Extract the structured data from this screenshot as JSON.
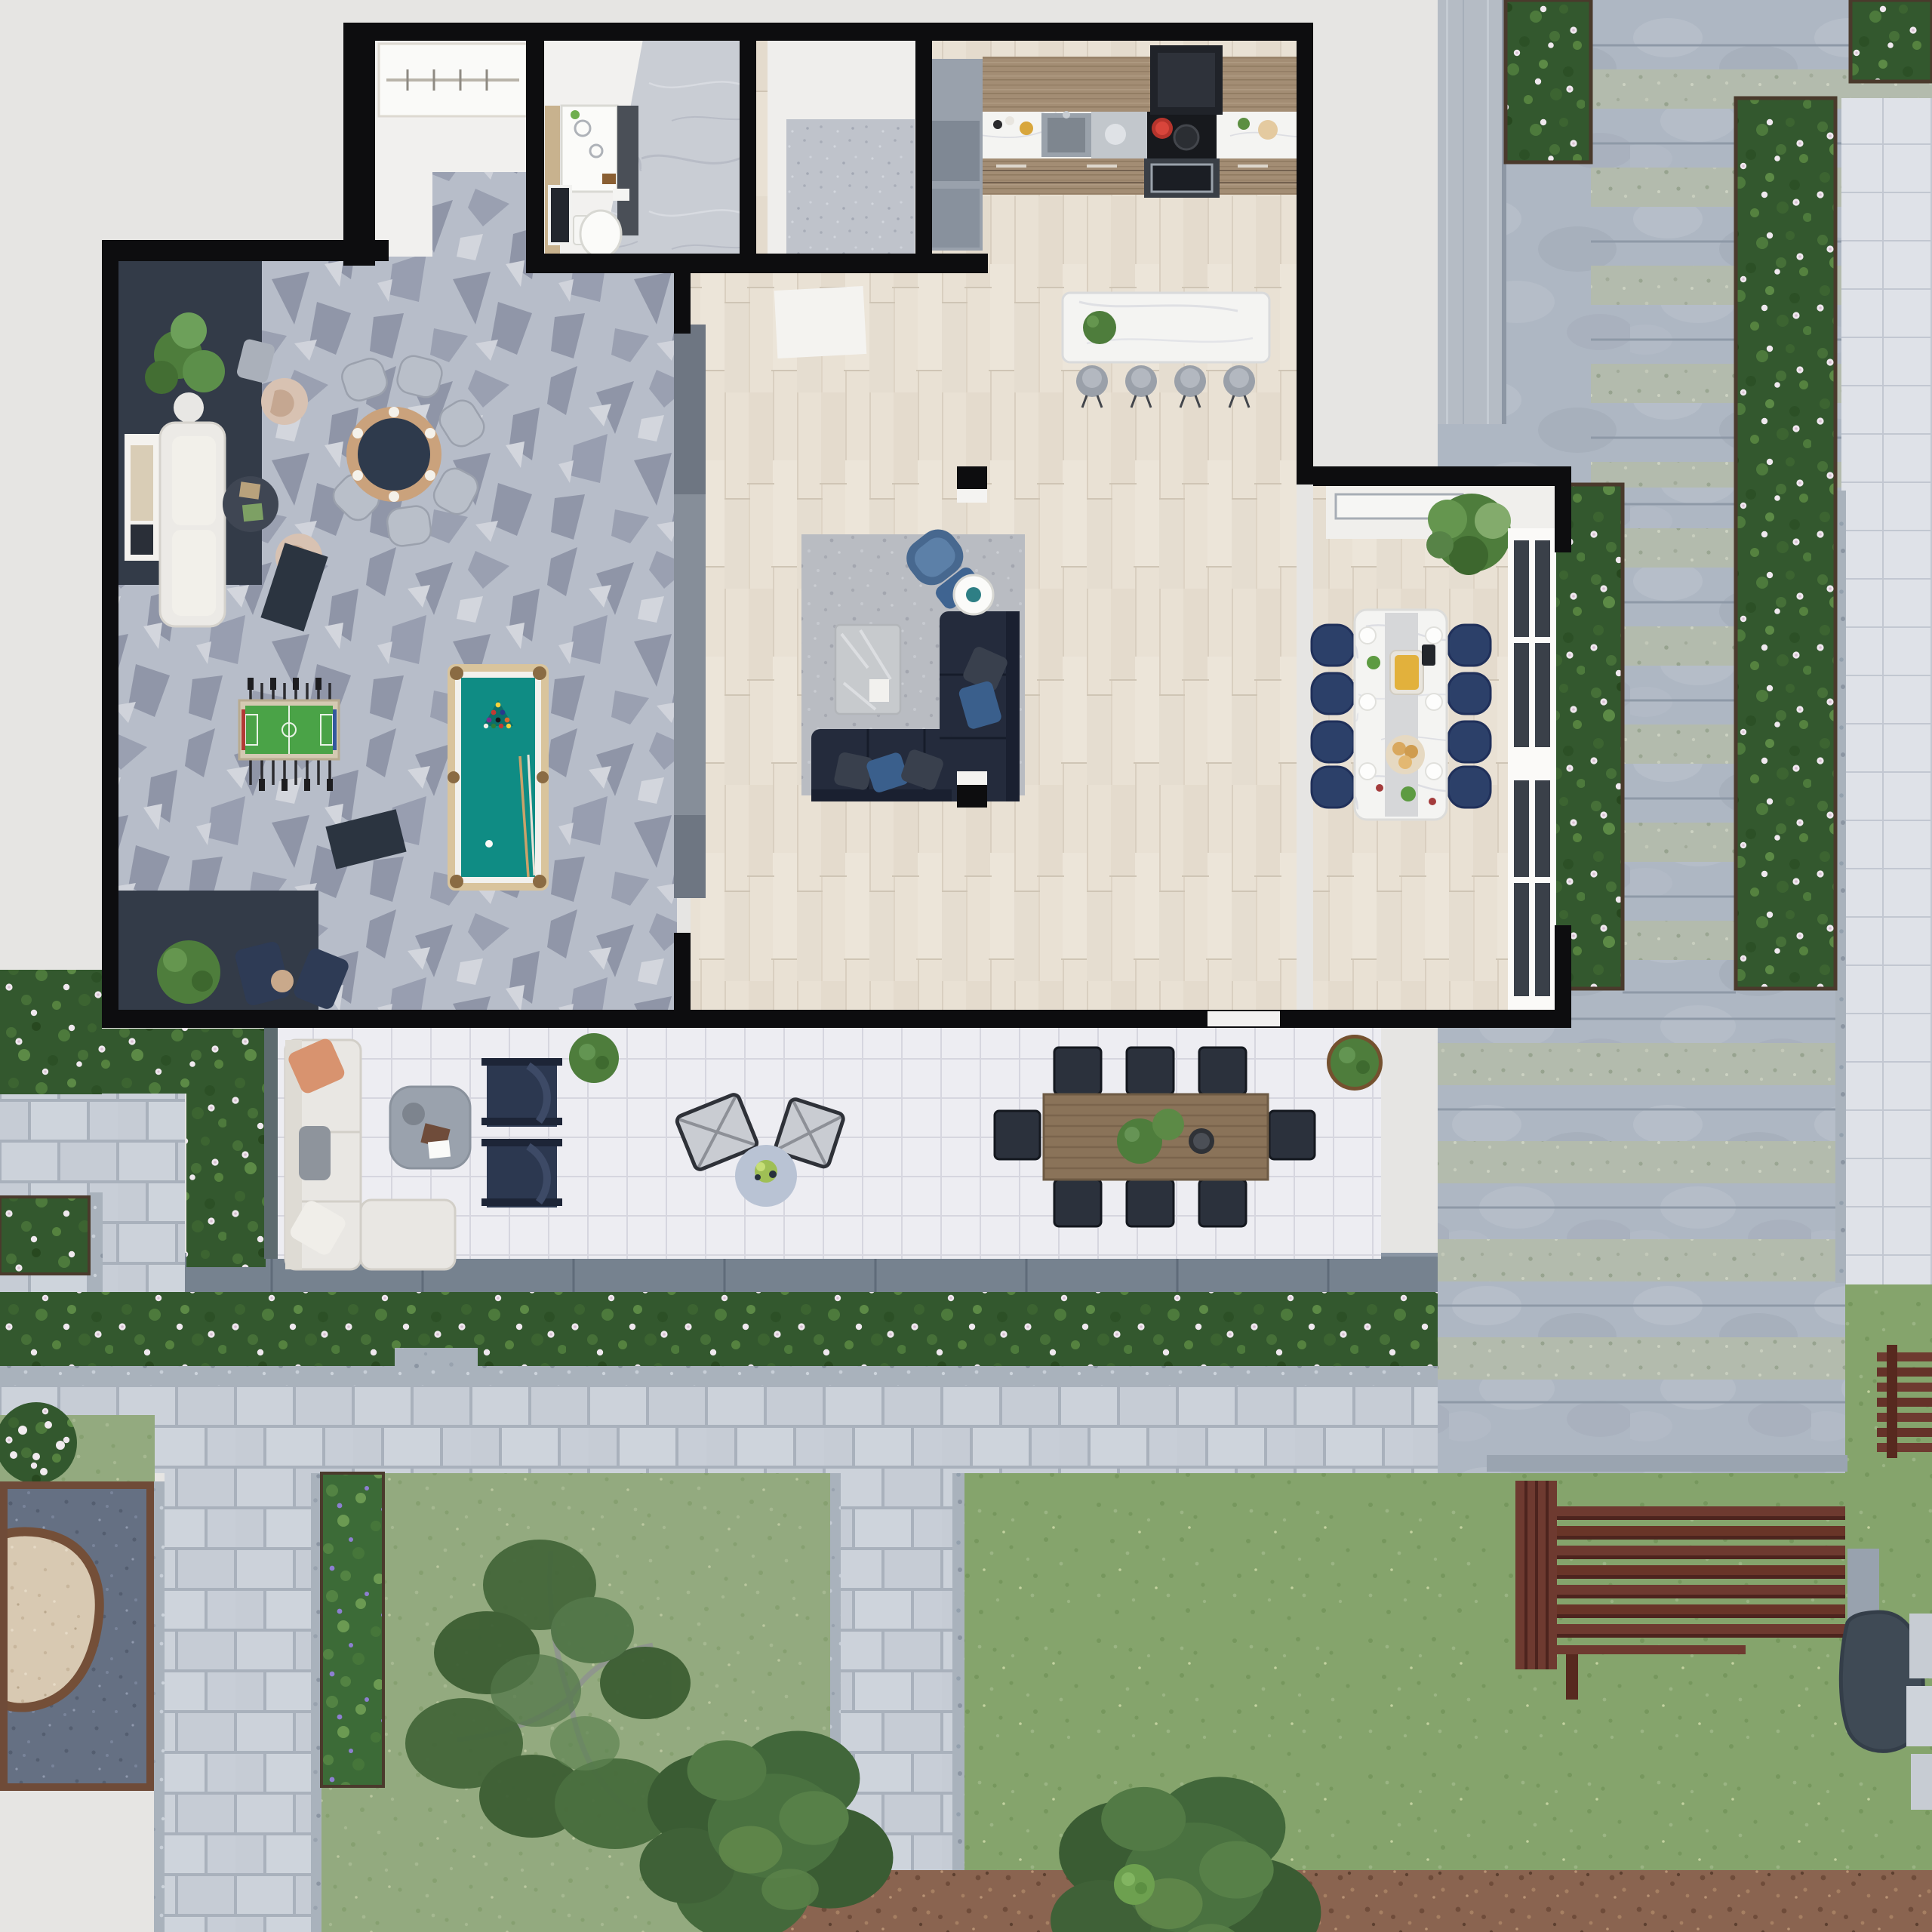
{
  "scene": {
    "type": "3d-floorplan-top-view",
    "description": "Top-down 3D architectural render of an apartment with game room, living room, kitchen, dining room, bathroom, large terrace and landscaped garden with stone staircase, flower hedges, lawns, trees, playground and timber benches"
  },
  "colors": {
    "background": "#e6e5e3",
    "wall": "#0d0d0f",
    "carpet_base": "#b7bdc9",
    "dark_floor": "#333b48",
    "wood_floor": "#e9e1d4",
    "counter_wood": "#a38d74",
    "marble_white": "#f4f4f2",
    "pool_felt": "#0f8c84",
    "pool_frame": "#d9c49c",
    "foosball_green": "#4aa347",
    "sofa_white": "#eceae6",
    "sofa_navy": "#242b3c",
    "rug_gray": "#b9bcc2",
    "armchair_beige": "#d8c2b2",
    "accent_blue_chair": "#47688f",
    "dining_chair_navy": "#2c4069",
    "terrace_tile": "#ededf2",
    "outdoor_sofa": "#e9e7e3",
    "lounger_navy": "#2c3850",
    "table_wood": "#8a7359",
    "bench_wood": "#6e3a30",
    "lawn": "#93aa7f",
    "hedge_green": "#33582e",
    "stone": "#aeb7c3",
    "coping": "#76828f",
    "paver": "#cdd3da",
    "gravel": "#a9b2bc",
    "mulch": "#8a6450",
    "rubber": "#657083",
    "sand": "#d8c9b2",
    "plant_green": "#4e7d3c"
  },
  "rooms": [
    {
      "id": "game-room",
      "label": "Game Room",
      "furniture": [
        "white two-seat sofa",
        "round coffee table",
        "two beige swivel armchairs",
        "gray ottoman",
        "round poker table with six chairs",
        "foosball table",
        "pool table with cues and racked balls",
        "two dark media benches",
        "potted plants",
        "framed wall art"
      ]
    },
    {
      "id": "bathroom",
      "label": "Bathroom",
      "furniture": [
        "vanity with double sink",
        "toilet",
        "framed art",
        "marble floor"
      ]
    },
    {
      "id": "entry-hall",
      "label": "Entry Hall",
      "furniture": [
        "wardrobe",
        "stone doormat"
      ]
    },
    {
      "id": "kitchen",
      "label": "Kitchen",
      "furniture": [
        "tall cabinet column",
        "counter run with sink",
        "stainless worktop",
        "black cooktop with red pot",
        "extractor hood",
        "oven",
        "marble island with plant",
        "four gray bar stools"
      ]
    },
    {
      "id": "living-room",
      "label": "Living Room",
      "furniture": [
        "L-shaped navy sectional with pillows",
        "silver coffee table",
        "blue armchair with ottoman",
        "round side table with bowl",
        "mottled gray rug",
        "media wall"
      ]
    },
    {
      "id": "dining-room",
      "label": "Dining Room",
      "furniture": [
        "long marble dining table with food",
        "eight navy upholstered chairs",
        "large potted plant",
        "ceiling light frame",
        "white french doors"
      ]
    },
    {
      "id": "terrace",
      "label": "Terrace",
      "furniture": [
        "white outdoor L-sofa with pillows",
        "square coffee table with tray",
        "two navy loungers",
        "two rope sling chairs",
        "round bistro table with plant",
        "timber outdoor dining table",
        "eight dark outdoor chairs",
        "potted shrubs"
      ]
    }
  ],
  "outdoor": {
    "elements": [
      "daisy flower hedge bands",
      "purple flower bed",
      "gravel strips",
      "paver walkways",
      "wide stone staircase with planted treads",
      "concrete retaining wall",
      "bluestone terrace coping",
      "main lawn",
      "corner lawns",
      "birch trees",
      "dense trees",
      "small shrub",
      "bark mulch path",
      "playground with rubber safety surface and sand island",
      "slatted mahogany benches",
      "slate stepping stones",
      "white paver columns"
    ]
  }
}
